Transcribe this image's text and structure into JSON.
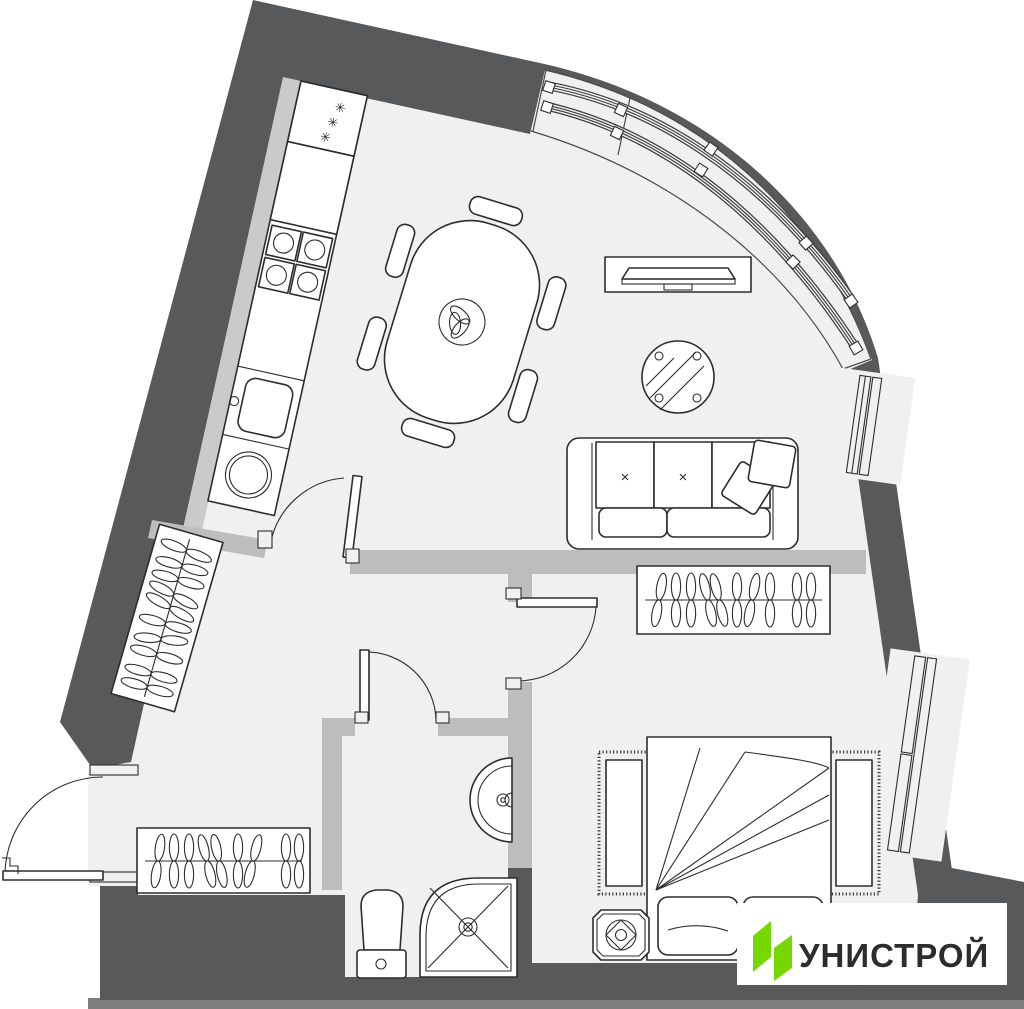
{
  "palette": {
    "background": "#ffffff",
    "wall": "#58595b",
    "wall_shadow": "#7c7d7f",
    "floor": "#f0f0f0",
    "partition": "#bdbdbe",
    "shaft": "#c9caca",
    "line": "#2d2d2d"
  },
  "brand": {
    "name": "УНИСТРОЙ",
    "accent_green": "#76d701",
    "text_color": "#3e474b"
  },
  "marks": {
    "fridge_star": "✳",
    "sofa_cushion": "×"
  }
}
